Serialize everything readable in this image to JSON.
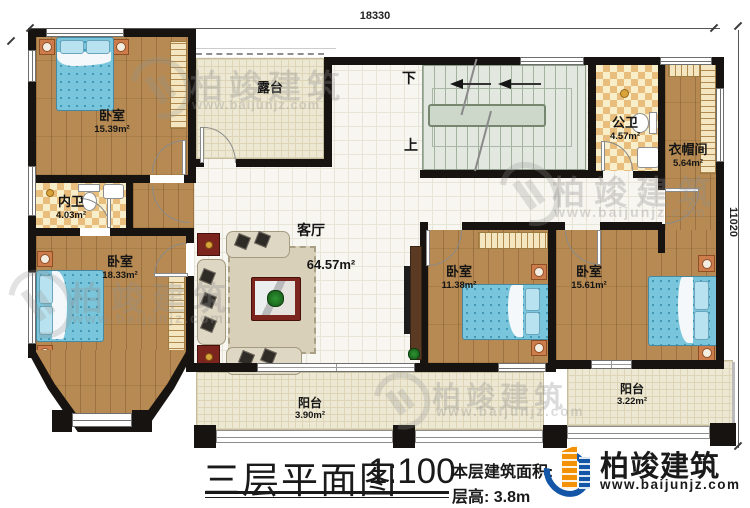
{
  "dimensions": {
    "top": "18330",
    "right": "11020"
  },
  "stairs": {
    "down": "下",
    "up": "上"
  },
  "rooms": {
    "bedroom_tl": {
      "label": "卧室",
      "area": "15.39m²"
    },
    "bath_inner": {
      "label": "内卫",
      "area": "4.03m²"
    },
    "bedroom_bl": {
      "label": "卧室",
      "area": "18.33m²"
    },
    "terrace": {
      "label": "露台"
    },
    "living": {
      "label": "客厅",
      "area": "64.57m²"
    },
    "bath_public": {
      "label": "公卫",
      "area": "4.57m²"
    },
    "cloakroom": {
      "label": "衣帽间",
      "area": "5.64m²"
    },
    "bedroom_bm": {
      "label": "卧室",
      "area": "11.38m²"
    },
    "bedroom_br": {
      "label": "卧室",
      "area": "15.61m²"
    },
    "balcony_left": {
      "label": "阳台",
      "area": "3.90m²"
    },
    "balcony_right": {
      "label": "阳台",
      "area": "3.22m²"
    }
  },
  "titleblock": {
    "title": "三层平面图",
    "scale": "1:100",
    "area_label": "本层建筑面积:",
    "floor_height": "层高: 3.8m"
  },
  "brand": {
    "name": "柏竣建筑",
    "website": "www.baijunjz.com",
    "blue": "#1355a7",
    "orange": "#f39206"
  },
  "watermark": {
    "name": "柏竣建筑",
    "website": "www.baijunjz.com"
  }
}
